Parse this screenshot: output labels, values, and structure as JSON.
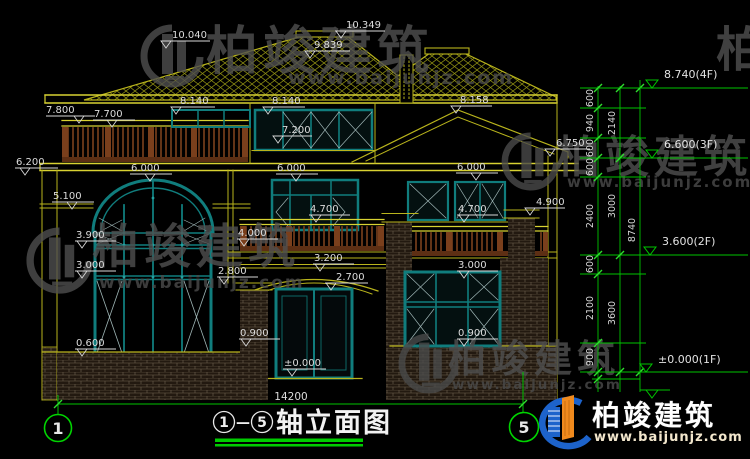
{
  "watermark": {
    "brand": "柏竣建筑",
    "url": "www.baijunjz.com"
  },
  "logo": {
    "brand": "柏竣建筑",
    "url": "www.baijunjz.com"
  },
  "drawing_title": {
    "axis_from": "1",
    "separator": "—",
    "axis_to": "5",
    "name": "轴立面图"
  },
  "axis_bubbles": {
    "left": "1",
    "right": "5"
  },
  "dimensions": {
    "total_width": "14200",
    "elevation_marks": [
      "10.040",
      "9.839",
      "10.349",
      "8.140",
      "8.140",
      "8.158",
      "7.800",
      "7.700",
      "7.200",
      "6.200",
      "6.750",
      "6.000",
      "6.000",
      "6.000",
      "5.100",
      "4.900",
      "4.700",
      "4.700",
      "4.000",
      "3.900",
      "3.200",
      "3.000",
      "3.000",
      "2.800",
      "2.700",
      "0.900",
      "0.900",
      "0.600",
      "±0.000"
    ],
    "floor_levels": [
      "8.740(4F)",
      "6.600(3F)",
      "3.600(2F)",
      "±0.000(1F)"
    ],
    "chain_inner": [
      "600",
      "940",
      "600",
      "600",
      "2400",
      "600",
      "2100",
      "900"
    ],
    "chain_middle": [
      "2140",
      "3000",
      "3600"
    ],
    "chain_outer": [
      "8740"
    ]
  },
  "colors": {
    "background": "#000000",
    "line_yellow": "#b9b41c",
    "bright_yellow": "#d8d232",
    "window_teal": "#107d7d",
    "railing_brown": "#6e3a1a",
    "dim_green": "#00c400",
    "text_white": "#dcdcdc",
    "watermark_gray": "#4f4f4f",
    "logo_blue": "#1d63cb",
    "logo_orange": "#f08a1d"
  }
}
